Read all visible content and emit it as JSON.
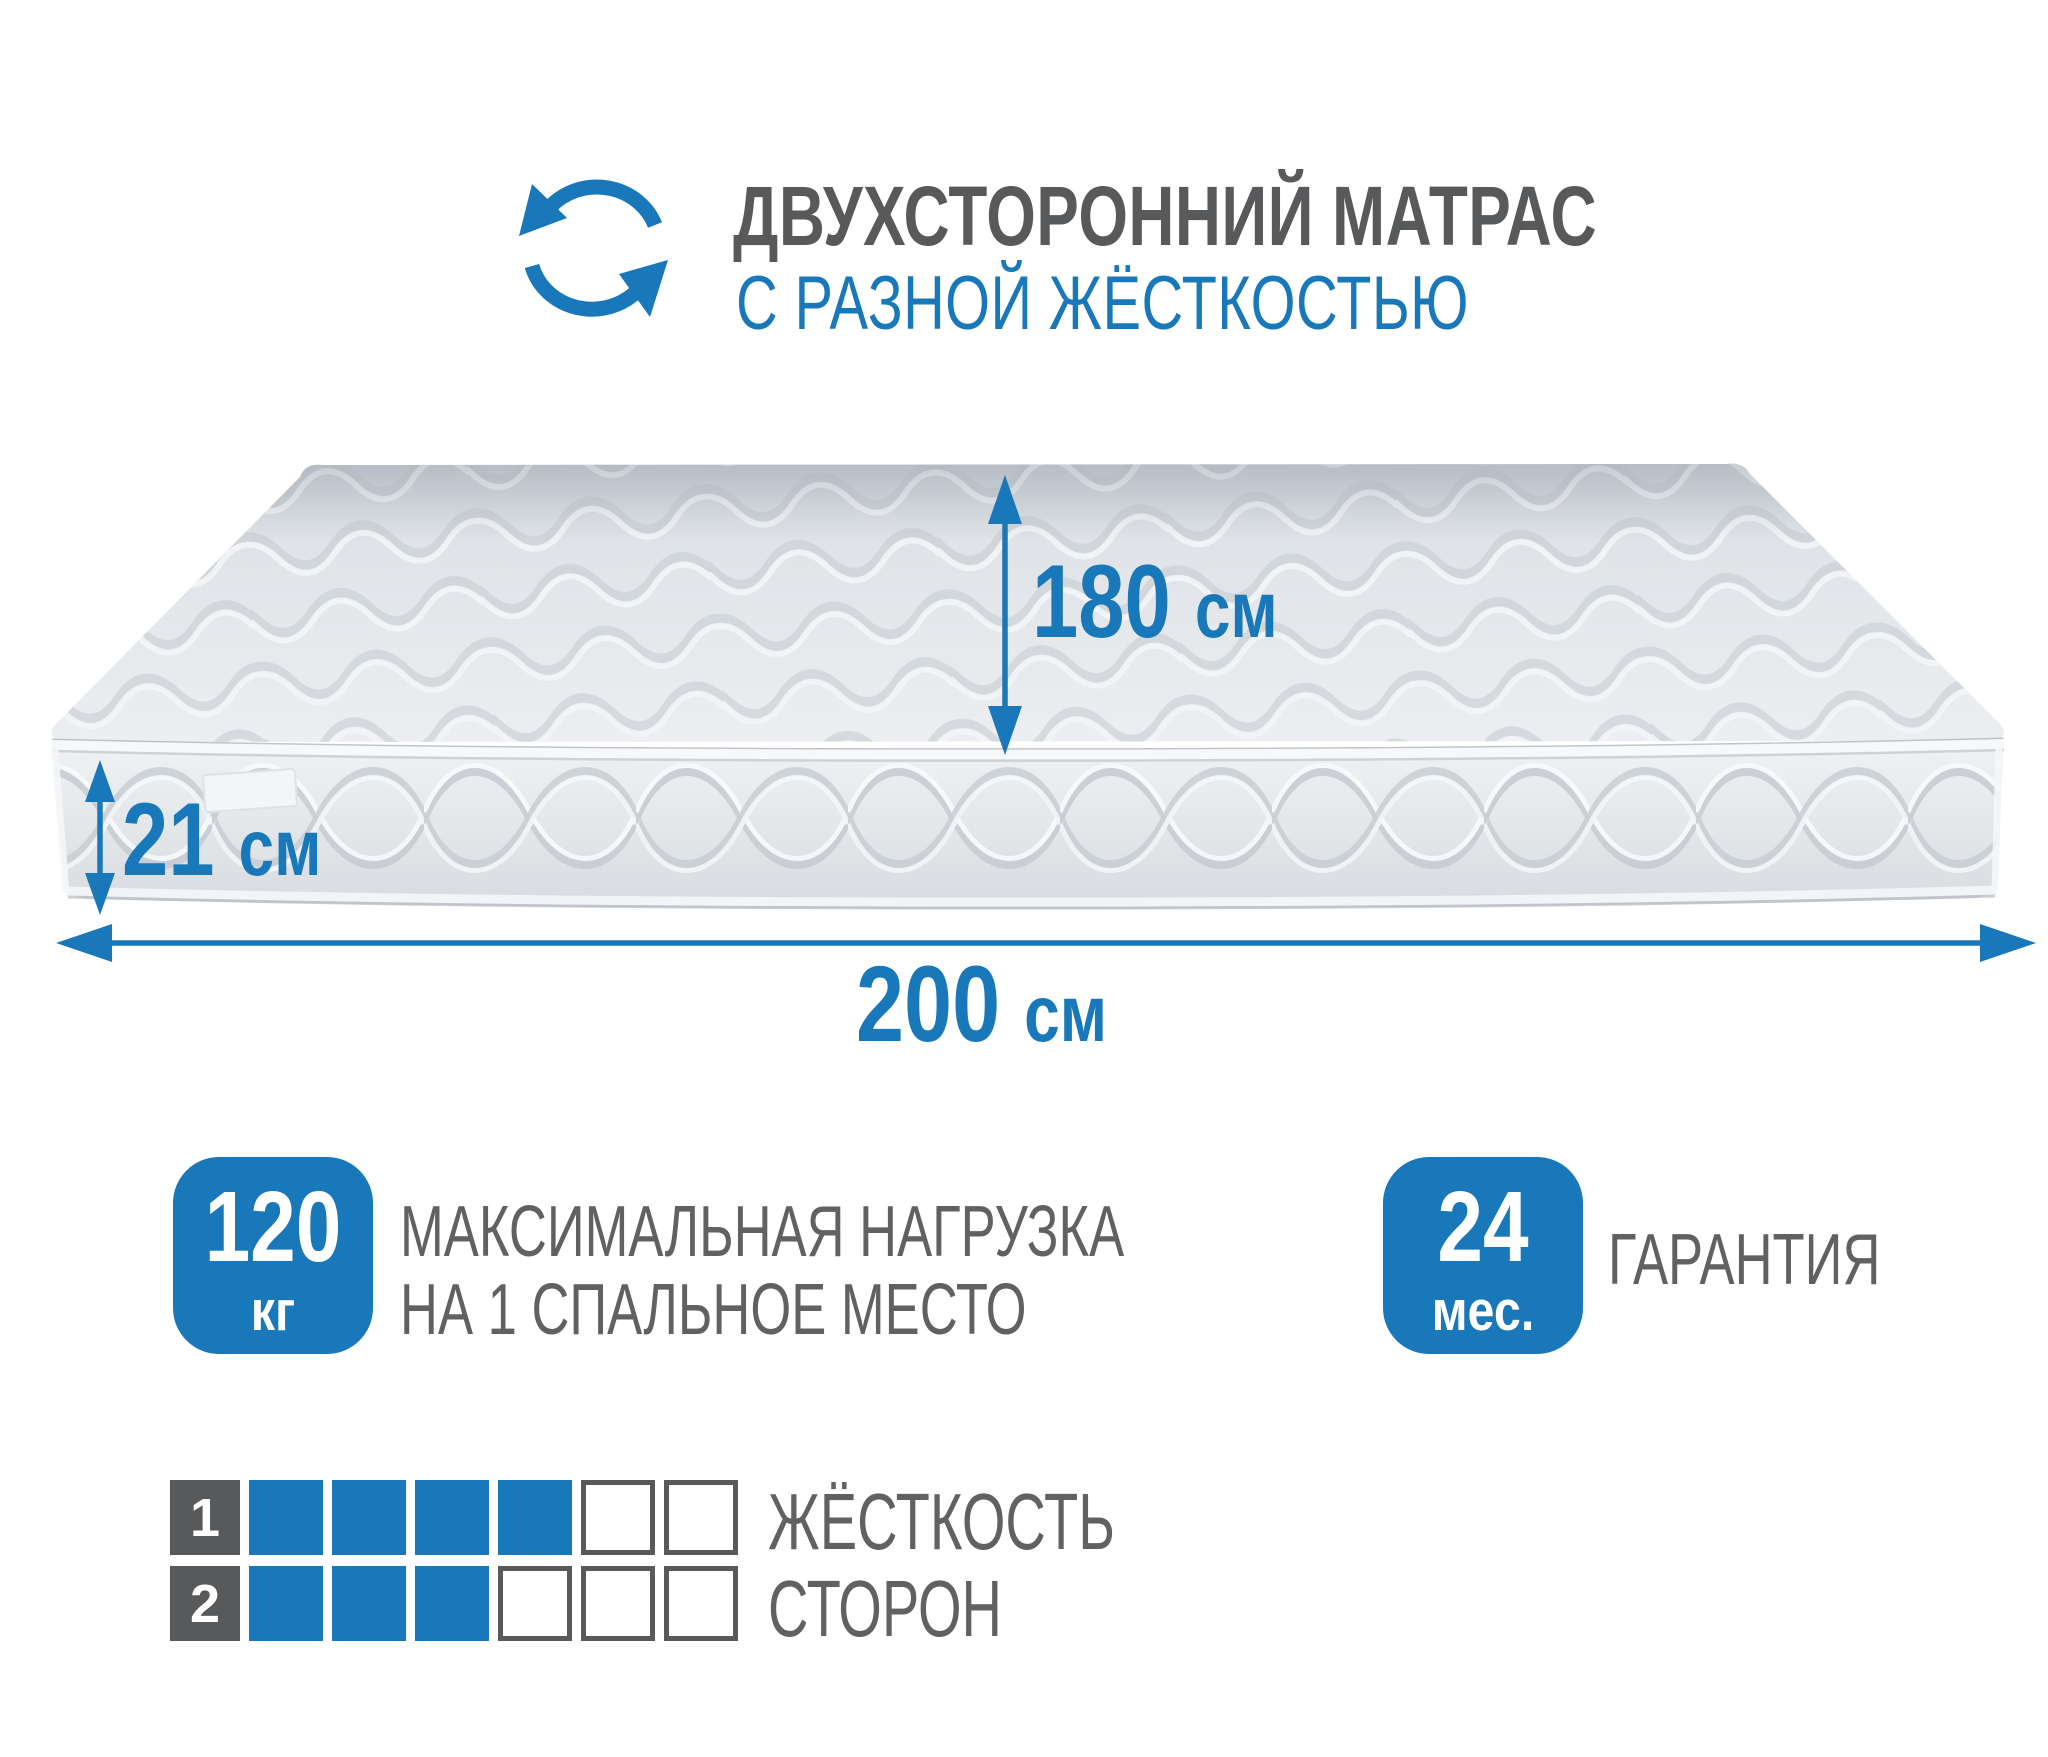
{
  "colors": {
    "accent": "#1878ba",
    "dark": "#58595b",
    "text_gray": "#5f6163"
  },
  "header": {
    "icon": "rotate-arrows-icon",
    "title": "ДВУХСТОРОННИЙ МАТРАС",
    "subtitle": "С РАЗНОЙ ЖЁСТКОСТЬЮ"
  },
  "dimensions": {
    "width": {
      "value": "180",
      "unit": "см"
    },
    "height": {
      "value": "21",
      "unit": "см"
    },
    "length": {
      "value": "200",
      "unit": "см"
    }
  },
  "badges": {
    "max_load": {
      "value": "120",
      "unit": "кг",
      "caption_line1": "МАКСИМАЛЬНАЯ НАГРУЗКА",
      "caption_line2": "НА 1 СПАЛЬНОЕ МЕСТО"
    },
    "warranty": {
      "value": "24",
      "unit": "мес.",
      "caption": "ГАРАНТИЯ"
    }
  },
  "firmness": {
    "caption_line1": "ЖЁСТКОСТЬ",
    "caption_line2": "СТОРОН",
    "scale_max": 6,
    "rows": [
      {
        "label": "1",
        "filled": 4
      },
      {
        "label": "2",
        "filled": 3
      }
    ]
  }
}
